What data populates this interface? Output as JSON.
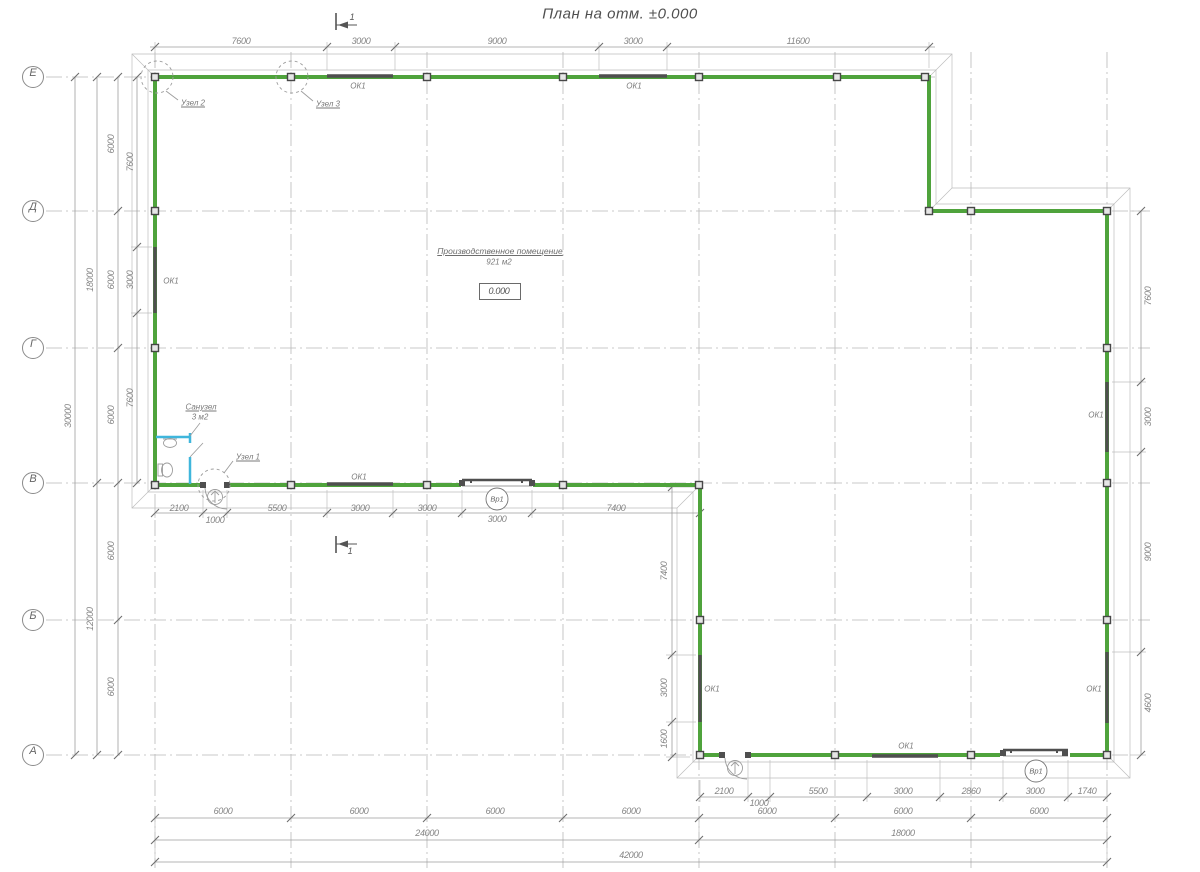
{
  "title": "План на отм. ±0.000",
  "axes": [
    "Е",
    "Д",
    "Г",
    "В",
    "Б",
    "А"
  ],
  "room": {
    "name": "Производственное помещение",
    "area": "921 м2",
    "level": "0.000"
  },
  "bathroom": {
    "name": "Санузел",
    "area": "3 м2"
  },
  "labels": {
    "window": "ОК1",
    "gate": "Вр1",
    "node_1": "Узел 1",
    "node_2": "Узел 2",
    "node_3": "Узел 3",
    "section": "1"
  },
  "dims": {
    "top": [
      "7600",
      "3000",
      "9000",
      "3000",
      "11600"
    ],
    "left_total": "30000",
    "left_spans": [
      "18000",
      "12000"
    ],
    "left_axis": [
      "6000",
      "6000",
      "6000",
      "6000",
      "6000"
    ],
    "left_inner": [
      "7600",
      "3000",
      "7600"
    ],
    "right_inner": [
      "7600",
      "3000",
      "9000",
      "4600"
    ],
    "notch_inner": [
      "7400",
      "3000",
      "1600"
    ],
    "wall_v": [
      "2100",
      "1000",
      "5500",
      "3000",
      "3000",
      "3000",
      "7400"
    ],
    "wall_a": [
      "2100",
      "1000",
      "5500",
      "3000",
      "2860",
      "3000",
      "1740"
    ],
    "bottom_axis": [
      "6000",
      "6000",
      "6000",
      "6000",
      "6000",
      "6000",
      "6000"
    ],
    "bottom_spans": [
      "24000",
      "18000"
    ],
    "bottom_total": "42000"
  },
  "colors": {
    "wall_green": "#4FA33C",
    "plumbing_blue": "#3FB6DC",
    "line_gray": "#9A9A9A",
    "fitting_dark": "#4F4F4F"
  }
}
